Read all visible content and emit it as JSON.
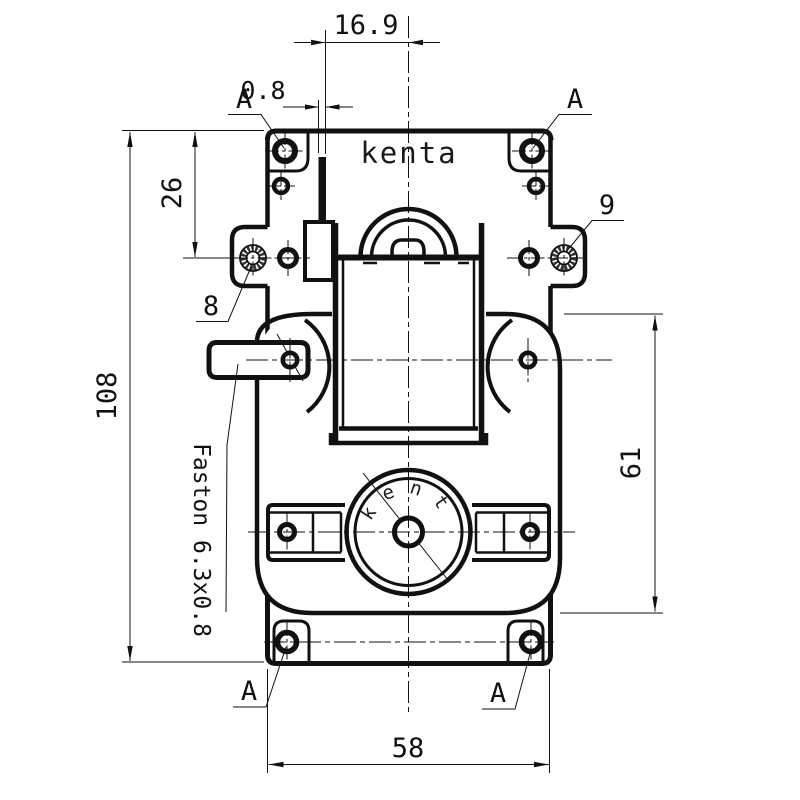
{
  "drawing": {
    "brand_label": "kenta",
    "logo_label": "kenta",
    "dimensions": {
      "terminal_offset": "16.9",
      "terminal_thickness": "0.8",
      "upper_hole_offset": "26",
      "overall_height": "108",
      "gearbox_height": "61",
      "mounting_width": "58"
    },
    "references": {
      "section_mark": "A",
      "side_hole_left": "8",
      "side_hole_right": "9",
      "terminal_spec": "Faston 6.3x0.8"
    },
    "colors": {
      "ink": "#111111",
      "paper": "#ffffff"
    }
  }
}
